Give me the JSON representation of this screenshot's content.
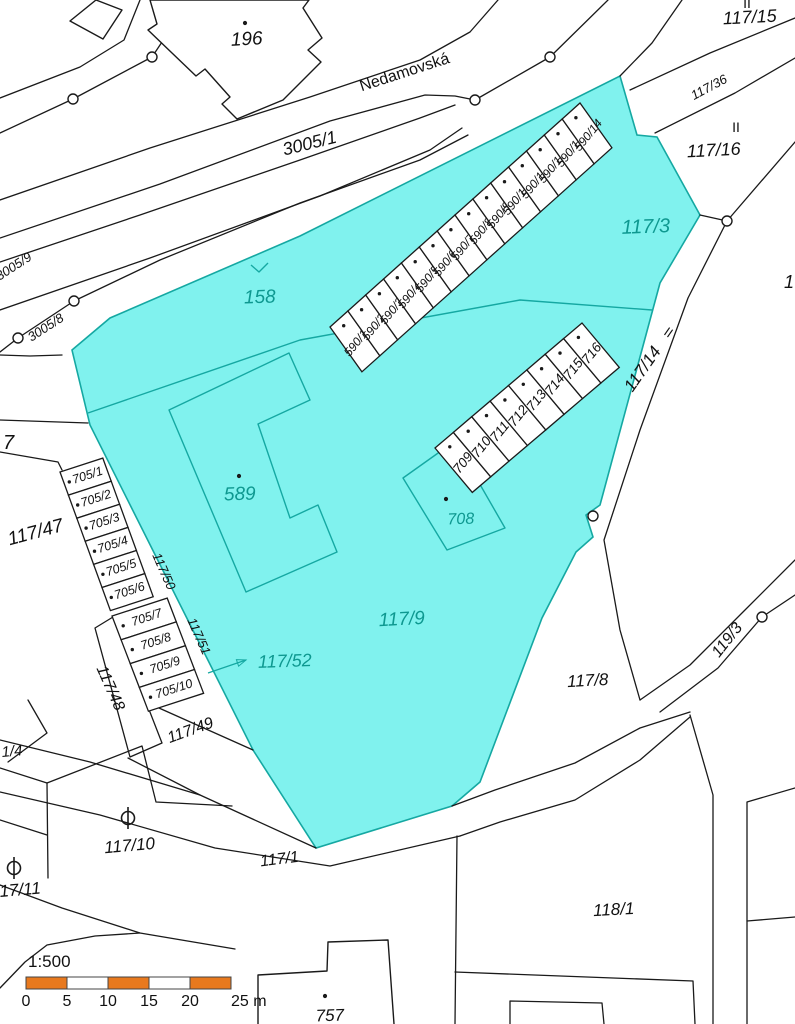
{
  "map_title": "Cadastral map with highlighted parcel area",
  "street": "Nedamovská",
  "colors": {
    "highlight_fill": "#80F2EE",
    "highlight_stroke": "#15A8A2",
    "teal_text": "#0E9890",
    "line": "#1a1a1a",
    "scale_orange": "#E8791E",
    "text": "#111111"
  },
  "labels": [
    {
      "t": "196",
      "x": 247,
      "y": 45,
      "r": -3,
      "s": 19,
      "c": "black"
    },
    {
      "t": "Nedamovská",
      "x": 406,
      "y": 77,
      "r": -18,
      "s": 16,
      "c": "black",
      "f": "n"
    },
    {
      "t": "3005/1",
      "x": 311,
      "y": 149,
      "r": -14,
      "s": 18,
      "c": "black"
    },
    {
      "t": "117/15",
      "x": 750,
      "y": 23,
      "r": -3,
      "s": 18,
      "c": "black"
    },
    {
      "t": "II",
      "x": 747,
      "y": 8,
      "r": 0,
      "s": 14,
      "c": "black",
      "f": "n"
    },
    {
      "t": "117/36",
      "x": 711,
      "y": 91,
      "r": -28,
      "s": 13,
      "c": "black"
    },
    {
      "t": "II",
      "x": 736,
      "y": 132,
      "r": 0,
      "s": 14,
      "c": "black",
      "f": "n"
    },
    {
      "t": "117/16",
      "x": 714,
      "y": 156,
      "r": -3,
      "s": 18,
      "c": "black"
    },
    {
      "t": "1",
      "x": 789,
      "y": 288,
      "r": 0,
      "s": 18,
      "c": "black"
    },
    {
      "t": "3005/9",
      "x": 16,
      "y": 270,
      "r": -33,
      "s": 13,
      "c": "black"
    },
    {
      "t": "3005/8",
      "x": 48,
      "y": 331,
      "r": -33,
      "s": 13,
      "c": "black"
    },
    {
      "t": "158",
      "x": 260,
      "y": 303,
      "r": -2,
      "s": 19,
      "c": "teal"
    },
    {
      "t": "117/3",
      "x": 646,
      "y": 233,
      "r": -2,
      "s": 20,
      "c": "teal"
    },
    {
      "t": "117/14",
      "x": 647,
      "y": 372,
      "r": -55,
      "s": 17,
      "c": "black"
    },
    {
      "t": "II",
      "x": 666,
      "y": 336,
      "r": 35,
      "s": 13,
      "c": "black",
      "f": "n"
    },
    {
      "t": "7",
      "x": 3,
      "y": 449,
      "r": 0,
      "s": 20,
      "c": "black",
      "a": "start"
    },
    {
      "t": "117/47",
      "x": 37,
      "y": 538,
      "r": -15,
      "s": 19,
      "c": "black"
    },
    {
      "t": "589",
      "x": 240,
      "y": 500,
      "r": -2,
      "s": 19,
      "c": "teal"
    },
    {
      "t": "117/50",
      "x": 160,
      "y": 573,
      "r": 66,
      "s": 13,
      "c": "black"
    },
    {
      "t": "117/51",
      "x": 195,
      "y": 638,
      "r": 66,
      "s": 13,
      "c": "black"
    },
    {
      "t": "708",
      "x": 461,
      "y": 524,
      "r": -2,
      "s": 16,
      "c": "teal"
    },
    {
      "t": "117/9",
      "x": 402,
      "y": 625,
      "r": -3,
      "s": 19,
      "c": "teal"
    },
    {
      "t": "117/52",
      "x": 285,
      "y": 667,
      "r": -2,
      "s": 18,
      "c": "teal"
    },
    {
      "t": "117/48",
      "x": 106,
      "y": 690,
      "r": 66,
      "s": 16,
      "c": "black"
    },
    {
      "t": "117/49",
      "x": 192,
      "y": 735,
      "r": -20,
      "s": 16,
      "c": "black"
    },
    {
      "t": "1/4",
      "x": 2,
      "y": 757,
      "r": -5,
      "s": 15,
      "c": "black",
      "a": "start"
    },
    {
      "t": "117/10",
      "x": 130,
      "y": 851,
      "r": -5,
      "s": 17,
      "c": "black"
    },
    {
      "t": "17/11",
      "x": 0,
      "y": 897,
      "r": -5,
      "s": 17,
      "c": "black",
      "a": "start"
    },
    {
      "t": "117/8",
      "x": 588,
      "y": 686,
      "r": -3,
      "s": 17,
      "c": "black"
    },
    {
      "t": "119/3",
      "x": 731,
      "y": 643,
      "r": -52,
      "s": 16,
      "c": "black"
    },
    {
      "t": "118/1",
      "x": 614,
      "y": 915,
      "r": -3,
      "s": 17,
      "c": "black"
    },
    {
      "t": "117/1",
      "x": 280,
      "y": 864,
      "r": -7,
      "s": 16,
      "c": "black"
    },
    {
      "t": "757",
      "x": 330,
      "y": 1021,
      "r": -2,
      "s": 17,
      "c": "black"
    }
  ],
  "garage_rows": [
    {
      "name": "garage-row-590",
      "labels": [
        "590/1",
        "590/2",
        "590/3",
        "590/4",
        "590/5",
        "590/6",
        "590/7",
        "590/8",
        "590/9",
        "590/10",
        "590/11",
        "590/12",
        "590/13",
        "590/14"
      ],
      "start": [
        330,
        327
      ],
      "u": [
        17.86,
        -16.0
      ],
      "v": [
        31.9,
        44.8
      ],
      "font": 12,
      "label_rot": -51,
      "label_v": 0.55,
      "dot_v": 0.15
    },
    {
      "name": "garage-row-709-716",
      "labels": [
        "709",
        "710",
        "711",
        "712",
        "713",
        "714",
        "715",
        "716"
      ],
      "start": [
        435,
        448
      ],
      "u": [
        18.37,
        -15.63
      ],
      "v": [
        37.3,
        44.4
      ],
      "font": 13.5,
      "label_rot": -51,
      "label_v": 0.52,
      "dot_v": 0.15
    },
    {
      "name": "garage-row-705a",
      "labels": [
        "705/1",
        "705/2",
        "705/3",
        "705/4",
        "705/5",
        "705/6"
      ],
      "start": [
        60,
        472
      ],
      "u": [
        8.4,
        23.1
      ],
      "v": [
        42.8,
        -13.9
      ],
      "font": 12.5,
      "label_rot": -18,
      "label_v": 0.55,
      "dot_v": 0.12
    },
    {
      "name": "garage-row-705b",
      "labels": [
        "705/7",
        "705/8",
        "705/9",
        "705/10"
      ],
      "start": [
        112,
        616
      ],
      "u": [
        9.1,
        23.8
      ],
      "v": [
        55.2,
        -17.9
      ],
      "font": 12.5,
      "label_rot": -18,
      "label_v": 0.55,
      "dot_v": 0.12
    }
  ],
  "boundary_markers": [
    [
      73,
      99
    ],
    [
      152,
      57
    ],
    [
      475,
      100
    ],
    [
      550,
      57
    ],
    [
      18,
      338
    ],
    [
      74,
      301
    ],
    [
      727,
      221
    ],
    [
      593,
      516
    ],
    [
      762,
      617
    ]
  ],
  "building_dots": [
    [
      245,
      23
    ],
    [
      239,
      476
    ],
    [
      446,
      499
    ],
    [
      325,
      996
    ]
  ],
  "orchard_symbols": [
    [
      128,
      818
    ],
    [
      14,
      868
    ]
  ],
  "arrow": {
    "from": [
      208,
      673
    ],
    "to": [
      246,
      660
    ]
  },
  "scalebar": {
    "ratio": "1:500",
    "ticks": [
      "0",
      "5",
      "10",
      "15",
      "20",
      "25 m"
    ],
    "x": 26,
    "y": 977,
    "w": 205,
    "h": 12,
    "segments": 5
  }
}
